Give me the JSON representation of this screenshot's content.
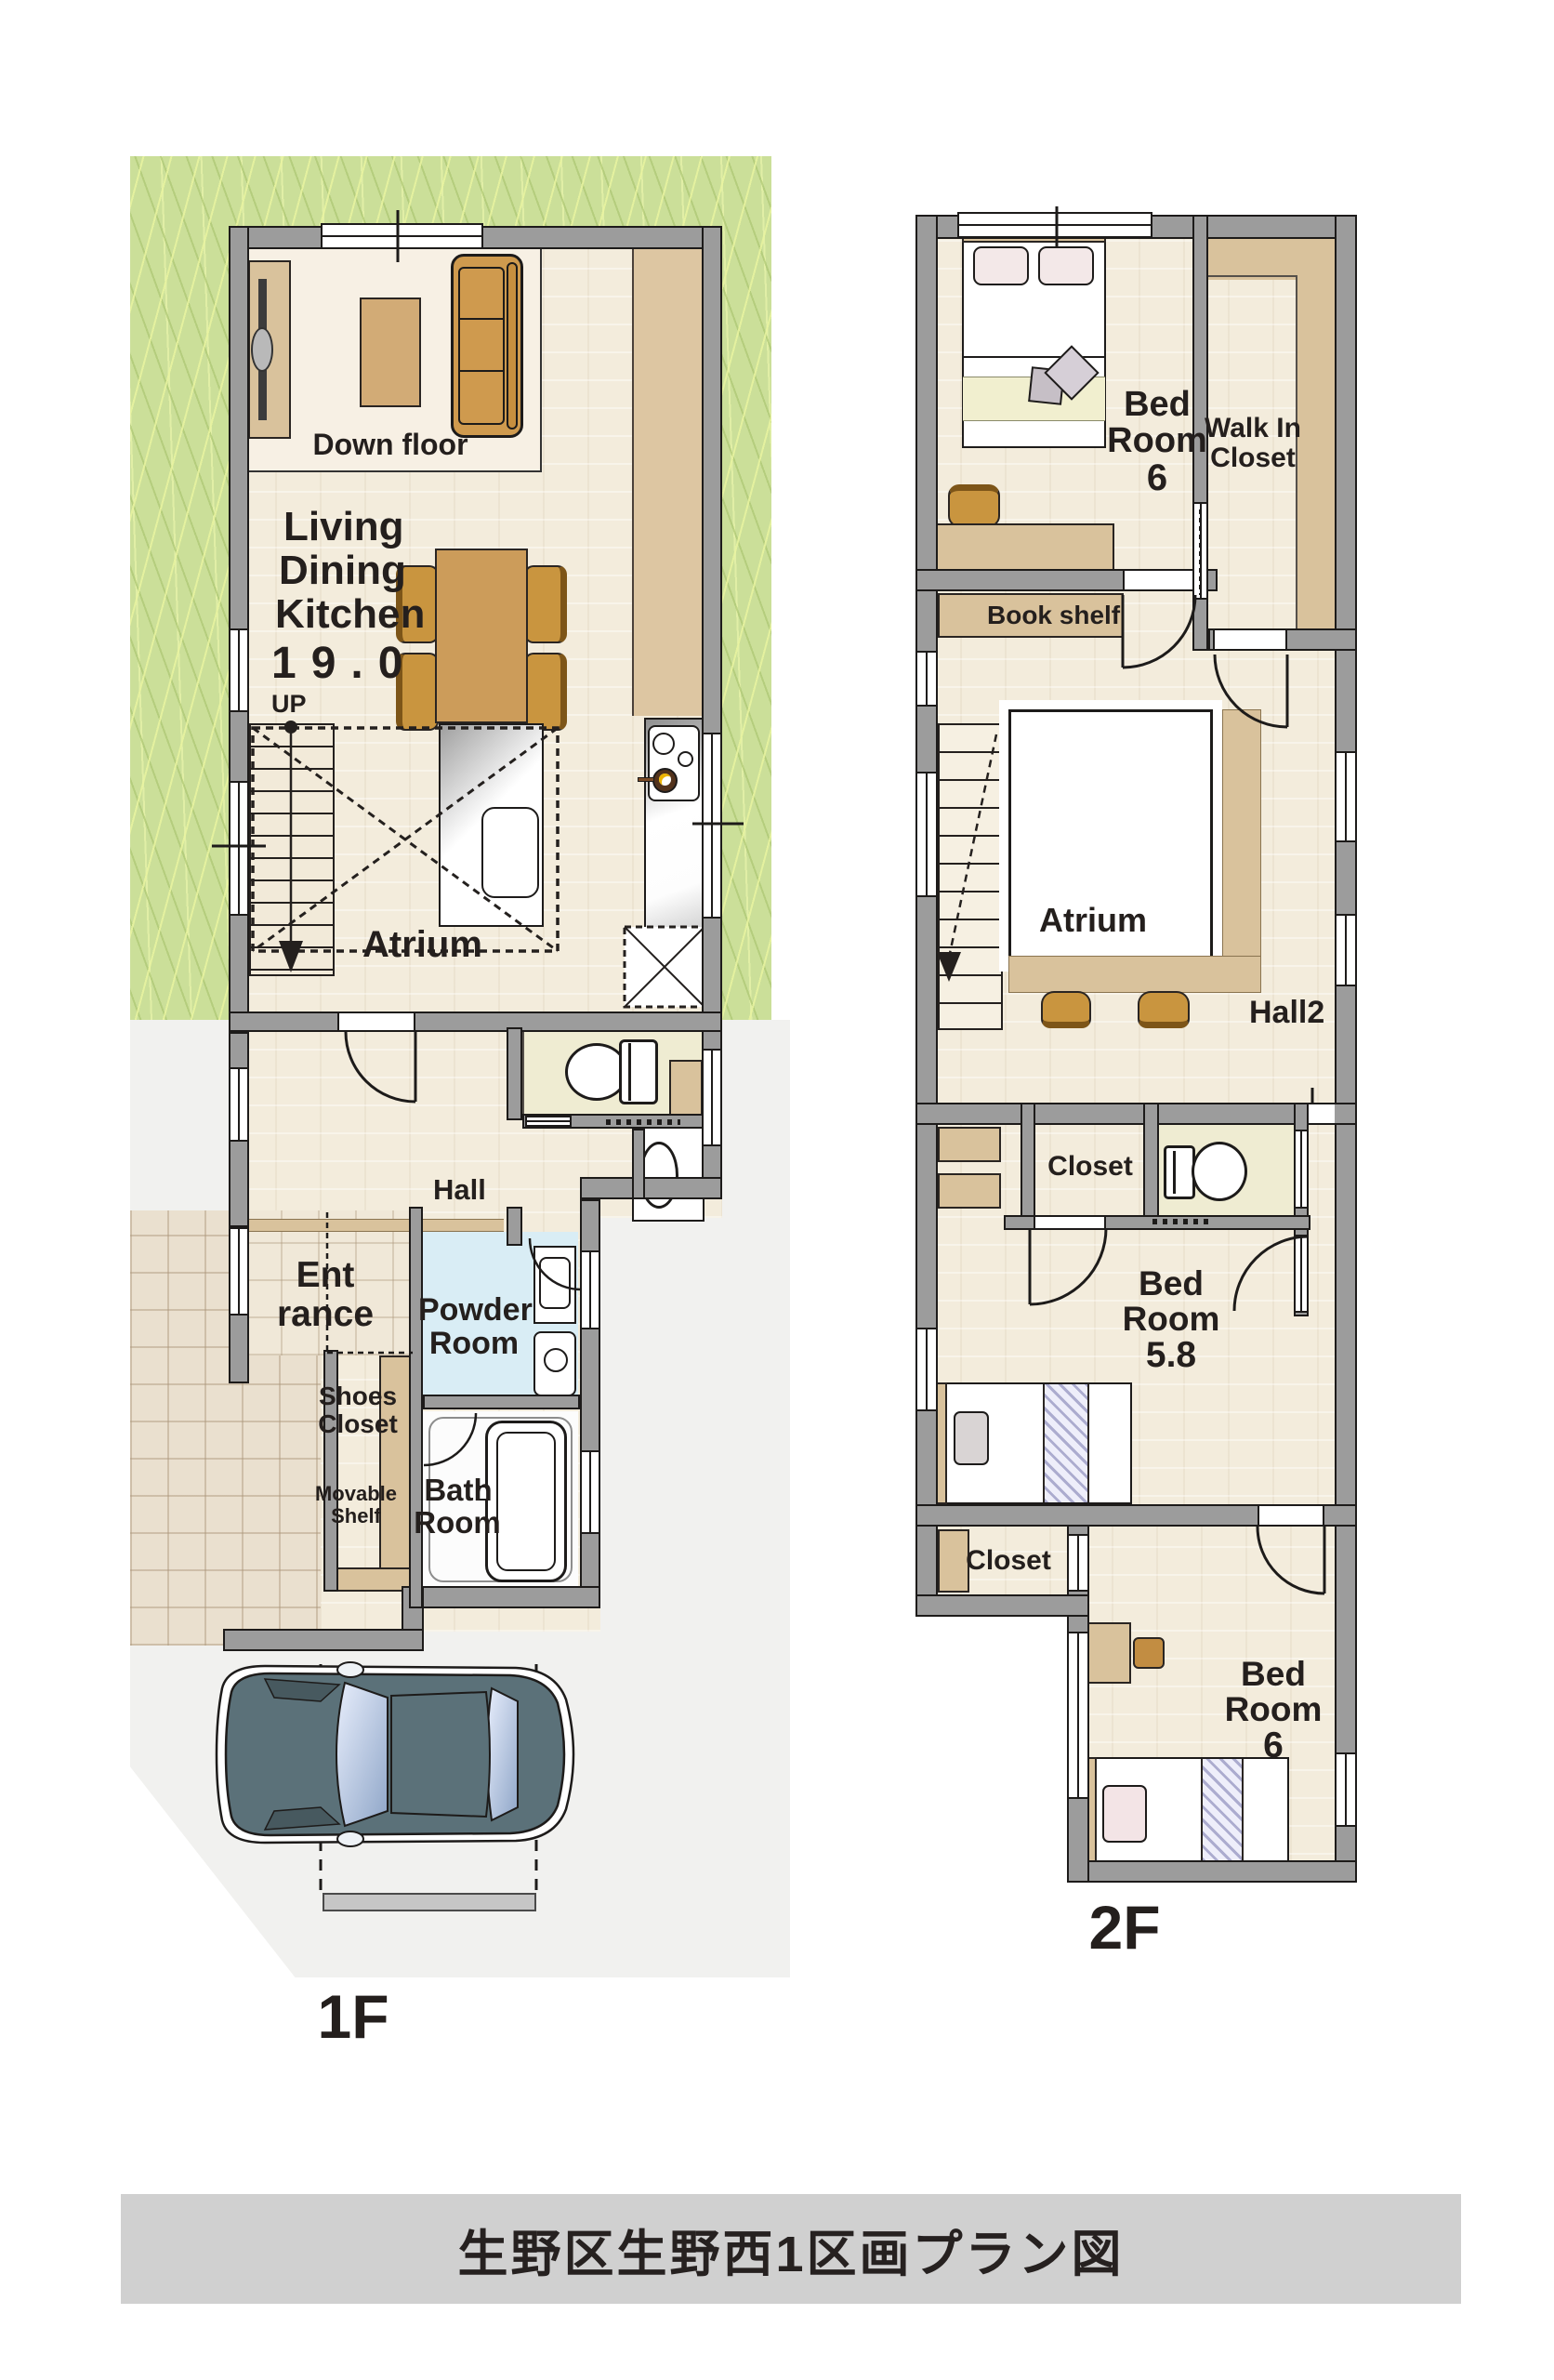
{
  "title": "生野区生野西1区画プラン図",
  "floor1": {
    "label": "1F",
    "down_floor": "Down floor",
    "ldk1": "Living",
    "ldk2": "Dining",
    "ldk3": "Kitchen",
    "ldk_size": "19.0",
    "up": "UP",
    "atrium": "Atrium",
    "hall": "Hall",
    "ent1": "Ent",
    "ent2": "rance",
    "shoes1": "Shoes",
    "shoes2": "Closet",
    "movable1": "Movable",
    "movable2": "Shelf",
    "powder1": "Powder",
    "powder2": "Room",
    "bath1": "Bath",
    "bath2": "Room"
  },
  "floor2": {
    "label": "2F",
    "bedroom_top1": "Bed",
    "bedroom_top2": "Room",
    "bedroom_top_size": "6",
    "wic1": "Walk In",
    "wic2": "Closet",
    "bookshelf": "Book shelf",
    "atrium": "Atrium",
    "hall2": "Hall2",
    "closet_mid": "Closet",
    "bedroom_mid1": "Bed",
    "bedroom_mid2": "Room",
    "bedroom_mid_size": "5.8",
    "closet_bottom": "Closet",
    "bedroom_bottom1": "Bed",
    "bedroom_bottom2": "Room",
    "bedroom_bottom_size": "6"
  },
  "colors": {
    "grass": "#cbdf99",
    "wall": "#9c9c9c",
    "floor": "#f3ecdc",
    "wood_shelf": "#d9c29c",
    "furniture_wood": "#cc9c5a",
    "powder_room": "#d9edf5",
    "toilet_floor": "#efecd2",
    "car_body": "#5b7179",
    "lot": "#f1f1ef",
    "title_bar": "#d0d0d0"
  }
}
